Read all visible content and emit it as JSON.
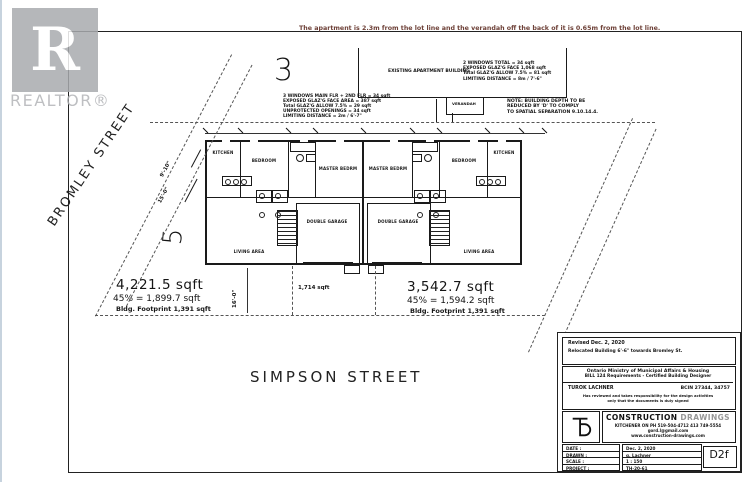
{
  "colors": {
    "note_red": "#6e4138",
    "watermark_gray": "#a9abae",
    "line_black": "#1a1a1a"
  },
  "watermark": {
    "letter": "R",
    "label": "REALTOR®"
  },
  "top_note": "The apartment is 2.3m from the lot line and the verandah off the back of it is 0.65m from the lot line.",
  "site": {
    "lot_number_large": "3",
    "lot_number_side": "5",
    "street_left": "BROMLEY STREET",
    "street_bottom": "SIMPSON STREET",
    "area_left": {
      "total": "4,221.5 sqft",
      "pct": "45% = 1,899.7 sqft",
      "footprint": "Bldg. Footprint 1,391 sqft"
    },
    "area_middle": "1,714 sqft",
    "area_right": {
      "total": "3,542.7 sqft",
      "pct": "45% = 1,594.2 sqft",
      "footprint": "Bldg. Footprint 1,391 sqft"
    },
    "dim_side_1": "9'-10\"",
    "dim_side_2": "15'-0\"",
    "dim_front": "16'-0\""
  },
  "apartment": {
    "label": "EXISTING APARTMENT BUILDING",
    "verandah": "VERANDAH",
    "note_left": [
      "3 WINDOWS MAIN FLR + 2ND FLR = 34 sqft",
      "EXPOSED GLAZ'G FACE AREA = 387 sqft",
      "Total GLAZ'G ALLOW 7.5% = 29 sqft",
      "UNPROTECTED OPENINGS = 34 sqft",
      "LIMITING DISTANCE = 2m / 6'-7\""
    ],
    "note_right": [
      "2 WINDOWS TOTAL = 34 sqft",
      "EXPOSED GLAZ'G FACE 1,068 sqft",
      "Total GLAZ'G ALLOW 7.5% = 81 sqft",
      "LIMITING DISTANCE = 8m / 7'-6\""
    ],
    "spatial_note": [
      "NOTE: BUILDING DEPTH TO BE",
      "REDUCED BY 'D' TO COMPLY",
      "TO SPATIAL SEPARATION 9.10.14.4."
    ]
  },
  "plan": {
    "rooms": {
      "kitchen": "KITCHEN",
      "bedroom": "BEDROOM",
      "master": "MASTER BEDRM",
      "living": "LIVING AREA",
      "garage": "DOUBLE GARAGE"
    }
  },
  "titleblock": {
    "revision_1": "Revised Dec. 2, 2020",
    "revision_2": "Relocated Building 6'-6\" towards Bromley St.",
    "ministry_1": "Ontario Ministry of Municipal Affairs & Housing",
    "ministry_2": "BILL 124 Requirements - Certified Building Designer",
    "designer": "TUROK LACHNER",
    "bcin": "BCIN 27344, 34757",
    "fine_1": "Has reviewed and takes responsibility for the design activities",
    "fine_2": "only that the documents is duly signed",
    "firm_title_1": "CONSTRUCTION",
    "firm_title_2": "DRAWINGS",
    "firm_line_1": "KITCHENER ON PH 519-504-4712 413 749-5554",
    "firm_line_2": "gord.l@gmail.com",
    "firm_line_3": "www.construction-drawings.com",
    "fields": [
      {
        "label": "DATE :",
        "value": "Dec. 2, 2020"
      },
      {
        "label": "DRAWN :",
        "value": "g. Lachner"
      },
      {
        "label": "SCALE :",
        "value": "1 : 150"
      },
      {
        "label": "PROJECT :",
        "value": "TH-20-61"
      }
    ],
    "sheet_no": "D2f"
  }
}
